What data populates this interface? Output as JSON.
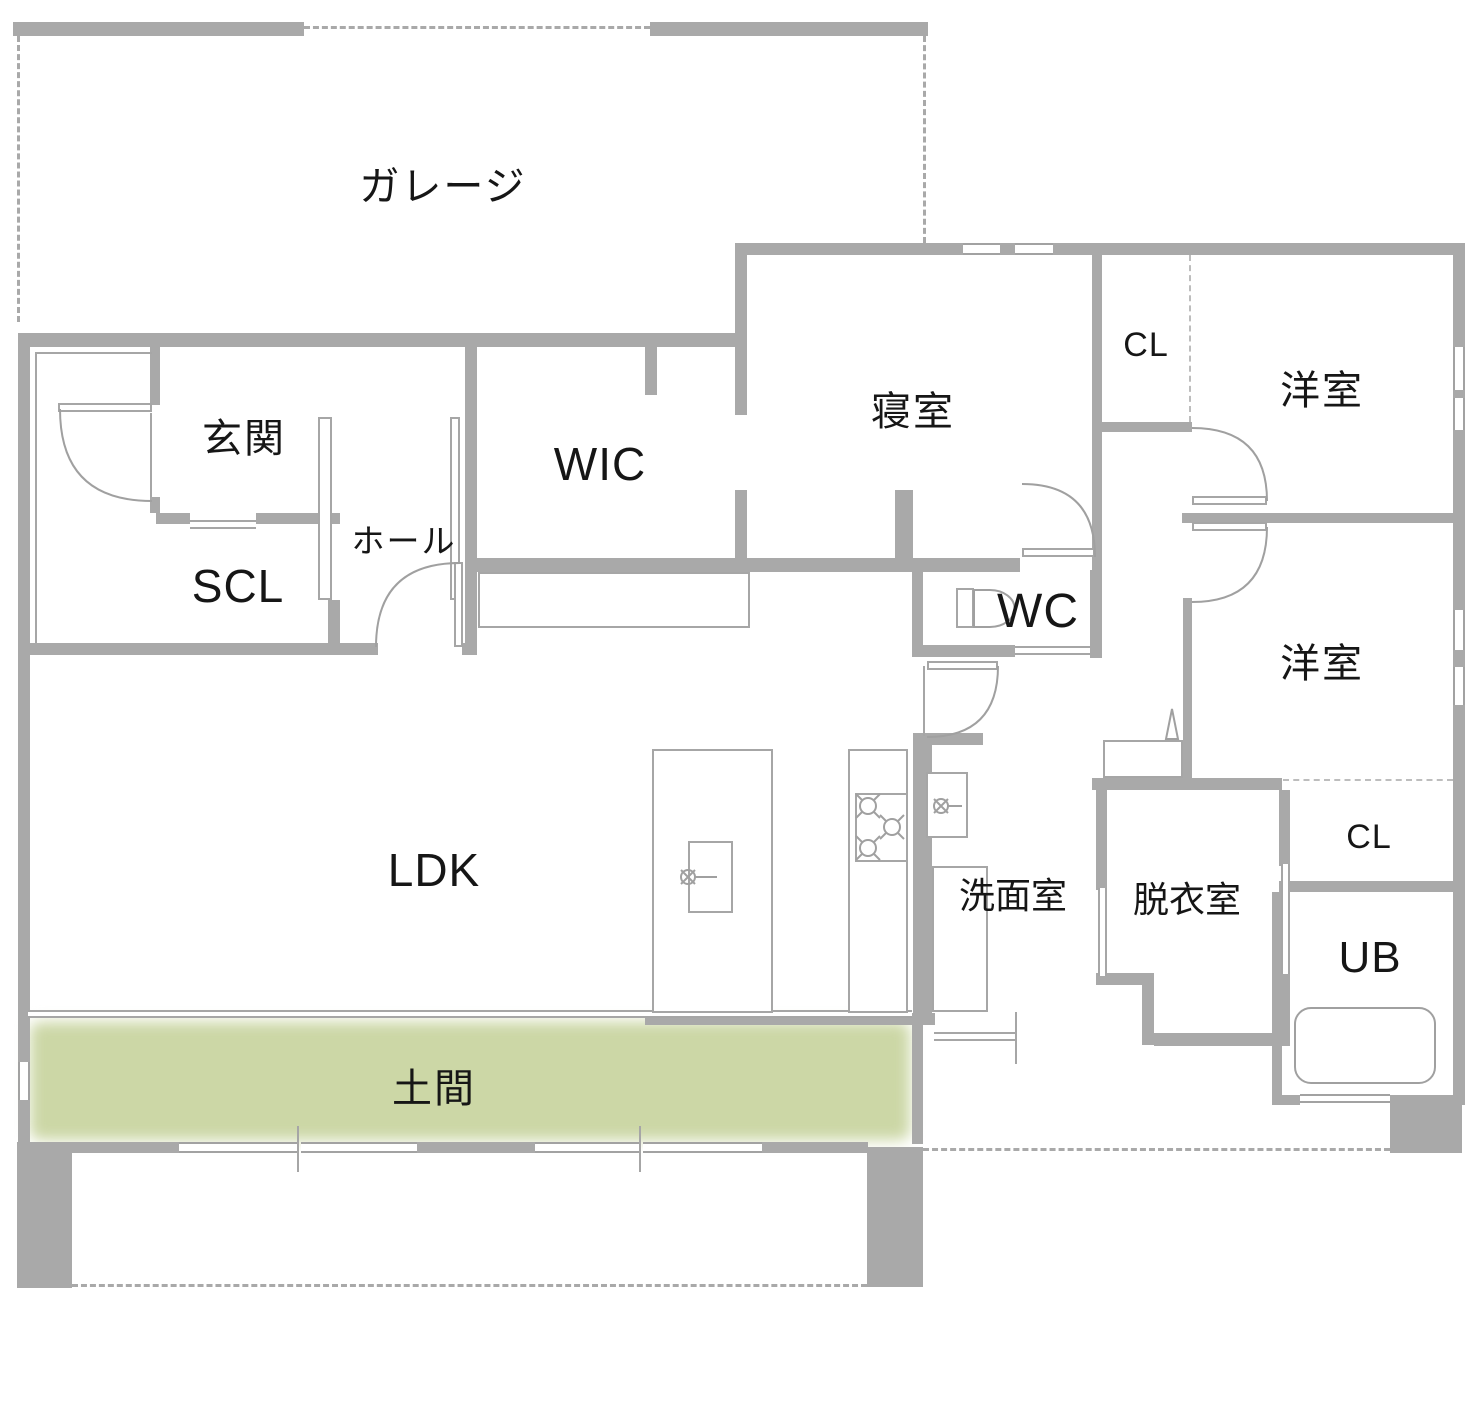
{
  "plan": {
    "type": "floor-plan",
    "rooms": {
      "garage": "ガレージ",
      "genkan": "玄関",
      "wic": "WIC",
      "bedroom": "寝室",
      "closet_upper": "CL",
      "western_room_upper": "洋室",
      "scl": "SCL",
      "hall": "ホール",
      "wc": "WC",
      "western_room_middle": "洋室",
      "ldk": "LDK",
      "washroom": "洗面室",
      "dressing_room": "脱衣室",
      "closet_lower": "CL",
      "unit_bath": "UB",
      "doma": "土間"
    },
    "icons": {
      "toilet": "toilet-icon",
      "bathtub": "bathtub-icon",
      "stove": "stove-burners-icon",
      "kitchen_sink": "kitchen-sink-icon",
      "faucet": "faucet-icon",
      "door_swing": "door-arc-icon"
    },
    "colors": {
      "wall": "#a9a9a9",
      "thin_line": "#a6a6a6",
      "dashed_line": "#a9a9a9",
      "doma_green": "#ccd7a6",
      "text": "#161616",
      "background": "#ffffff"
    }
  }
}
